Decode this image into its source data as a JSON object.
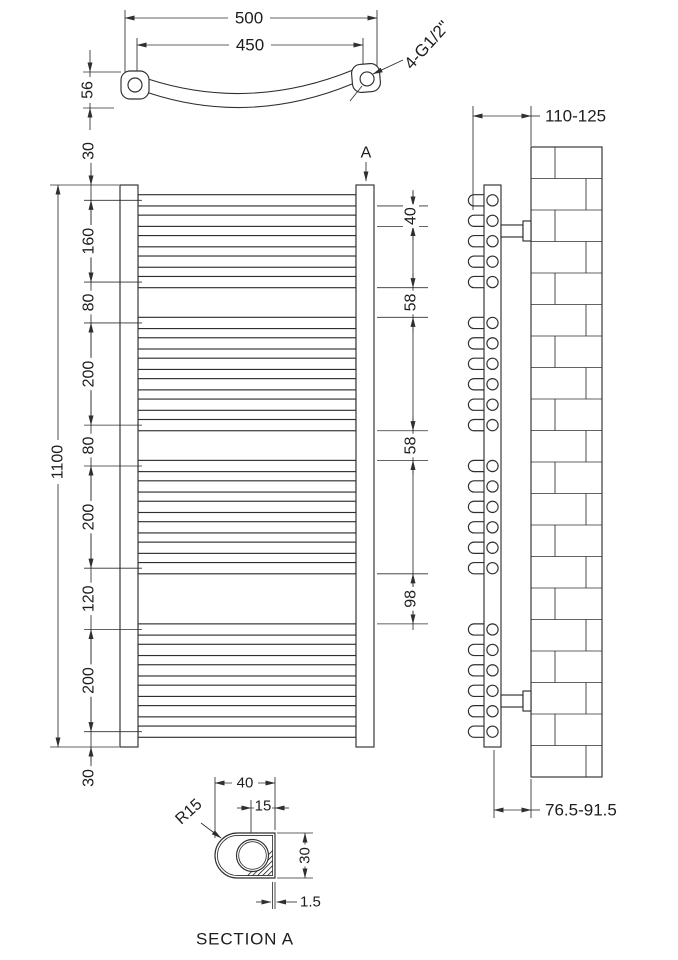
{
  "views": {
    "top": {
      "dim_overall_width": "500",
      "dim_inner_width": "450",
      "dim_bow_depth": "56",
      "connection_label": "4-G1/2\""
    },
    "front": {
      "section_arrow": "A",
      "dim_total_height": "1100",
      "left_chain": [
        "30",
        "160",
        "80",
        "200",
        "80",
        "200",
        "120",
        "200",
        "30"
      ],
      "right_chain": [
        "40",
        "58",
        "58",
        "98"
      ],
      "rung_groups": [
        5,
        6,
        6,
        6
      ]
    },
    "side": {
      "dim_bracket_top": "110-125",
      "dim_bracket_bottom": "76.5-91.5",
      "brick_rows": 20
    },
    "section_a": {
      "title": "SECTION A",
      "dim_width": "40",
      "dim_hole_offset": "15",
      "dim_height": "30",
      "dim_wall": "1.5",
      "dim_radius": "R15"
    }
  },
  "colors": {
    "line": "#2f2f2f",
    "background": "#ffffff"
  }
}
